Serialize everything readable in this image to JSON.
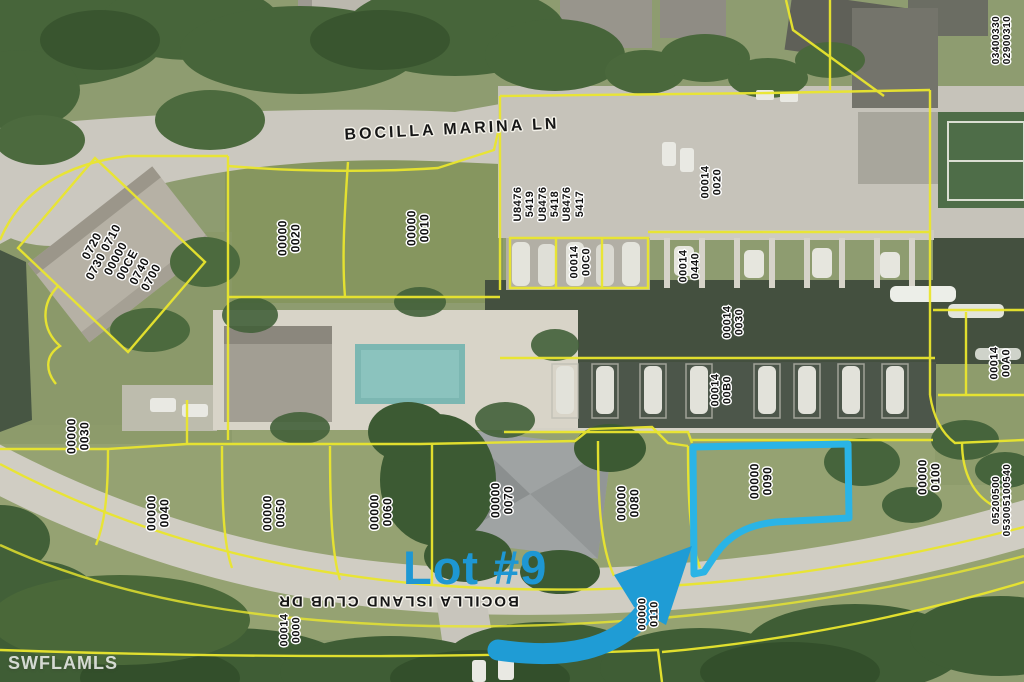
{
  "map": {
    "colors": {
      "parcel_line": "#eae62e",
      "highlight": "#2ab4e6",
      "arrow": "#1f9cd5",
      "callout": "#1e97d3",
      "water": "#44503f"
    },
    "streets": [
      {
        "id": "bocilla-marina-ln",
        "name": "BOCILLA MARINA LN",
        "x": 452,
        "y": 130,
        "rot": -3,
        "fs": 16,
        "ls": 3
      },
      {
        "id": "bocilla-island-club-dr",
        "name": "BOCILLA ISLAND CLUB DR",
        "x": 398,
        "y": 601,
        "rot": 180,
        "fs": 15,
        "ls": 2
      }
    ],
    "callout": {
      "label": "Lot #9"
    },
    "watermark": {
      "text": "SWFLAMLS"
    },
    "parcels": [
      {
        "id": "condo-block",
        "lines": [
          "0720",
          "0730 0710",
          "00000",
          "00CE",
          "0740",
          "0700"
        ],
        "x": 122,
        "y": 262,
        "rot": -62,
        "fs": 12
      },
      {
        "id": "lot-0020",
        "lines": [
          "00000",
          "0020"
        ],
        "x": 290,
        "y": 238,
        "rot": -90,
        "fs": 12
      },
      {
        "id": "lot-0010",
        "lines": [
          "00000",
          "0010"
        ],
        "x": 419,
        "y": 228,
        "rot": -90,
        "fs": 12
      },
      {
        "id": "dock-u8476",
        "lines": [
          "U8476",
          "5419",
          "U8476",
          "5418",
          "U8476",
          "5417"
        ],
        "x": 549,
        "y": 204,
        "rot": -90,
        "fs": 11
      },
      {
        "id": "lot-00014-0020",
        "lines": [
          "00014",
          "0020"
        ],
        "x": 712,
        "y": 182,
        "rot": -90,
        "fs": 11
      },
      {
        "id": "lot-00014-0440",
        "lines": [
          "00014",
          "0440"
        ],
        "x": 690,
        "y": 266,
        "rot": -90,
        "fs": 11
      },
      {
        "id": "dock-00014-00C0",
        "lines": [
          "00014",
          "00C0"
        ],
        "x": 581,
        "y": 262,
        "rot": -90,
        "fs": 11
      },
      {
        "id": "canal-00014-0030",
        "lines": [
          "00014",
          "0030"
        ],
        "x": 734,
        "y": 322,
        "rot": -90,
        "fs": 11
      },
      {
        "id": "dock-00014-00B0",
        "lines": [
          "00014",
          "00B0"
        ],
        "x": 722,
        "y": 390,
        "rot": -90,
        "fs": 11
      },
      {
        "id": "lot-00014-00A0",
        "lines": [
          "00014",
          "00A0"
        ],
        "x": 1001,
        "y": 363,
        "rot": -90,
        "fs": 11
      },
      {
        "id": "lot-0030",
        "lines": [
          "00000",
          "0030"
        ],
        "x": 79,
        "y": 436,
        "rot": -90,
        "fs": 12
      },
      {
        "id": "lot-0040",
        "lines": [
          "00000",
          "0040"
        ],
        "x": 159,
        "y": 513,
        "rot": -90,
        "fs": 12
      },
      {
        "id": "lot-0050",
        "lines": [
          "00000",
          "0050"
        ],
        "x": 275,
        "y": 513,
        "rot": -90,
        "fs": 12
      },
      {
        "id": "lot-0060",
        "lines": [
          "00000",
          "0060"
        ],
        "x": 382,
        "y": 512,
        "rot": -90,
        "fs": 12
      },
      {
        "id": "lot-0070",
        "lines": [
          "00000",
          "0070"
        ],
        "x": 503,
        "y": 500,
        "rot": -90,
        "fs": 12
      },
      {
        "id": "lot-0080",
        "lines": [
          "00000",
          "0080"
        ],
        "x": 629,
        "y": 503,
        "rot": -90,
        "fs": 12
      },
      {
        "id": "lot-0090",
        "lines": [
          "00000",
          "0090"
        ],
        "x": 762,
        "y": 481,
        "rot": -90,
        "fs": 12
      },
      {
        "id": "lot-0100",
        "lines": [
          "00000",
          "0100"
        ],
        "x": 930,
        "y": 477,
        "rot": -90,
        "fs": 12
      },
      {
        "id": "straps-0520",
        "lines": [
          "05200500",
          "053005100540"
        ],
        "x": 1002,
        "y": 500,
        "rot": -90,
        "fs": 10
      },
      {
        "id": "straps-0340",
        "lines": [
          "03400330",
          "02900310"
        ],
        "x": 1002,
        "y": 40,
        "rot": -90,
        "fs": 10
      },
      {
        "id": "lot-00014-0000",
        "lines": [
          "00014",
          "0000"
        ],
        "x": 291,
        "y": 630,
        "rot": -90,
        "fs": 11
      },
      {
        "id": "lot-0110",
        "lines": [
          "00000",
          "0110"
        ],
        "x": 649,
        "y": 614,
        "rot": -90,
        "fs": 11
      }
    ]
  }
}
